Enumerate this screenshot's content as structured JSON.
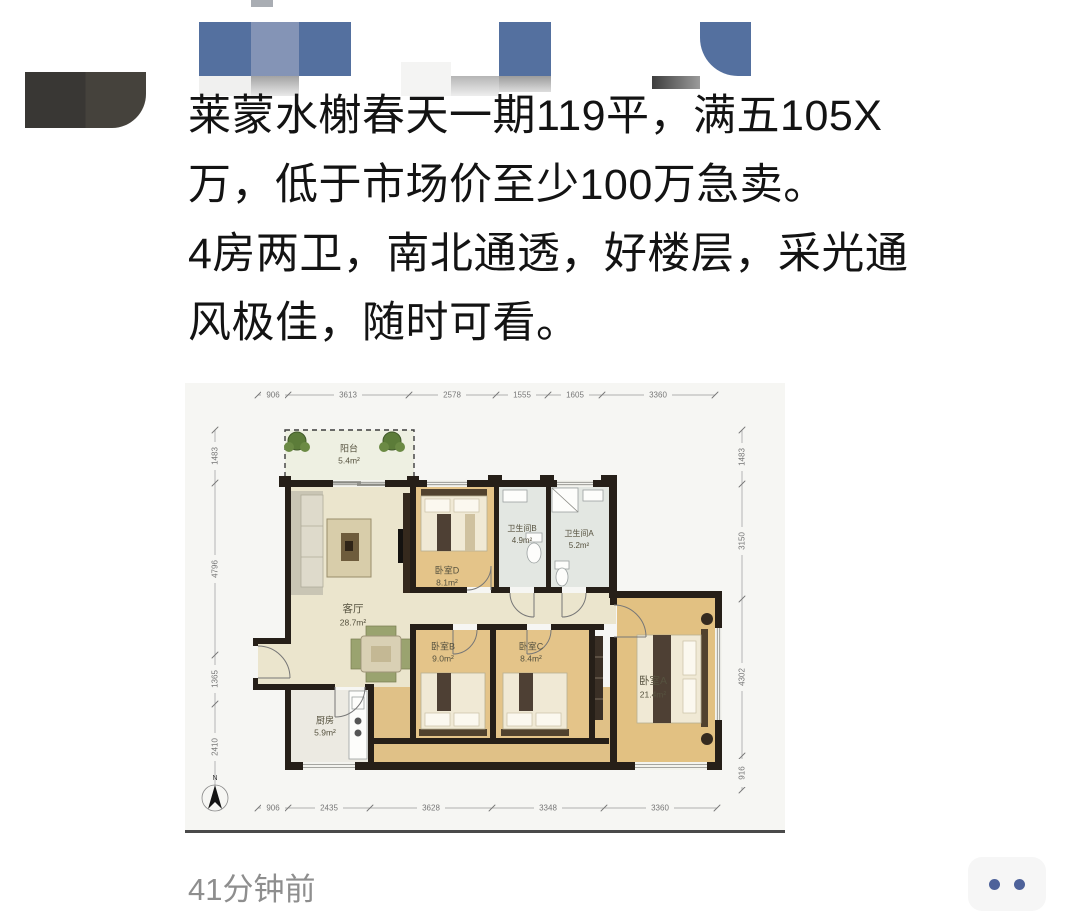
{
  "post": {
    "text_lines": [
      "莱蒙水榭春天一期119平，满五105X",
      "万，低于市场价至少100万急卖。",
      "4房两卫，南北通透，好楼层，采光通",
      "风极佳，随时可看。"
    ],
    "timestamp": "41分钟前"
  },
  "floorplan": {
    "rooms": [
      {
        "name": "阳台",
        "area": "5.4m²"
      },
      {
        "name": "客厅",
        "area": "28.7m²"
      },
      {
        "name": "卧室D",
        "area": "8.1m²"
      },
      {
        "name": "卫生间B",
        "area": "4.9m²"
      },
      {
        "name": "卫生间A",
        "area": "5.2m²"
      },
      {
        "name": "卧室B",
        "area": "9.0m²"
      },
      {
        "name": "卧室C",
        "area": "8.4m²"
      },
      {
        "name": "卧室A",
        "area": "21.4m²"
      },
      {
        "name": "厨房",
        "area": "5.9m²"
      }
    ],
    "dims_top": [
      "906",
      "3613",
      "2578",
      "1555",
      "1605",
      "3360"
    ],
    "dims_bottom": [
      "906",
      "2435",
      "3628",
      "3348",
      "3360"
    ],
    "dims_left": [
      "1483",
      "4796",
      "1365",
      "2410"
    ],
    "dims_right": [
      "1483",
      "3150",
      "4302",
      "916"
    ],
    "north_label": "N"
  },
  "action": {
    "more_icon": "two-dots"
  },
  "colors": {
    "mosaic_blue": "#54709f",
    "mosaic_blue_light": "#8494b6",
    "avatar_dark": "#393734",
    "dot_blue": "#4e629a",
    "wall": "#261f18",
    "floor_living": "#ebe5cd",
    "floor_bedroom": "#e4c489",
    "floor_bath": "#e3e7e2",
    "plan_bg": "#f6f6f3"
  }
}
